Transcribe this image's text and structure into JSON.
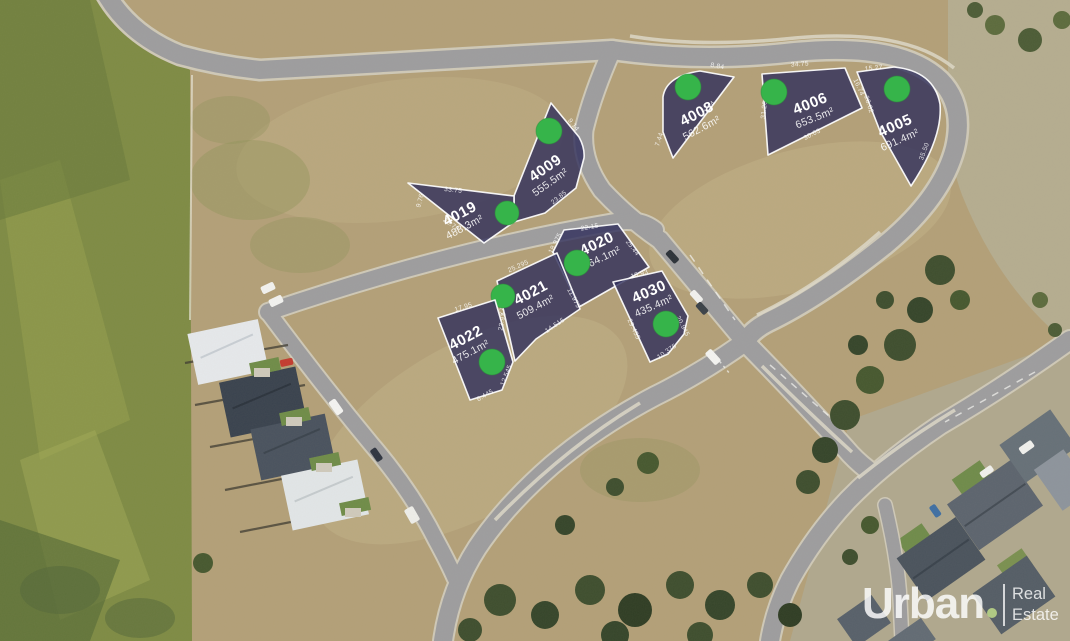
{
  "map_title": "aerial-lot-release-map",
  "palette": {
    "lot_fill": "#302e5b",
    "lot_stroke": "#ffffff",
    "marker_green": "#36b44a",
    "road_gray": "#9d9d9f",
    "dirt_tan": "#b3a078",
    "field_green": "#7e8b44",
    "tree_green": "#3e4e2e"
  },
  "branding": {
    "name": "Urban",
    "dot": ".",
    "tagline_line1": "Real",
    "tagline_line2": "Estate",
    "text_color": "#ffffff",
    "dot_color": "#c0dc8a"
  },
  "lots": [
    {
      "id": "4005",
      "area": "691.4m²",
      "dims": [
        "15.27",
        "28.02",
        "35.50"
      ]
    },
    {
      "id": "4006",
      "area": "653.5m²",
      "dims": [
        "34.75",
        "16.74",
        "31.26",
        "30.03"
      ]
    },
    {
      "id": "4008",
      "area": "562.6m²",
      "dims": [
        "8.84",
        "41.24",
        "7.44"
      ]
    },
    {
      "id": "4009",
      "area": "555.5m²",
      "dims": [
        "9.14",
        "23.85"
      ]
    },
    {
      "id": "4019",
      "area": "488.3m²",
      "dims": [
        "33.75",
        "9.76",
        "26.78"
      ]
    },
    {
      "id": "4020",
      "area": "464.1m²",
      "dims": [
        "22.15",
        "18.975",
        "25.44"
      ]
    },
    {
      "id": "4021",
      "area": "509.4m²",
      "dims": [
        "25.295",
        "27.92",
        "11.975",
        "14.515"
      ]
    },
    {
      "id": "4022",
      "area": "475.1m²",
      "dims": [
        "17.95",
        "23.92",
        "12.545",
        "6.445"
      ]
    },
    {
      "id": "4030",
      "area": "435.4m²",
      "dims": [
        "15.93",
        "29.455",
        "20.945",
        "10.375"
      ]
    }
  ]
}
